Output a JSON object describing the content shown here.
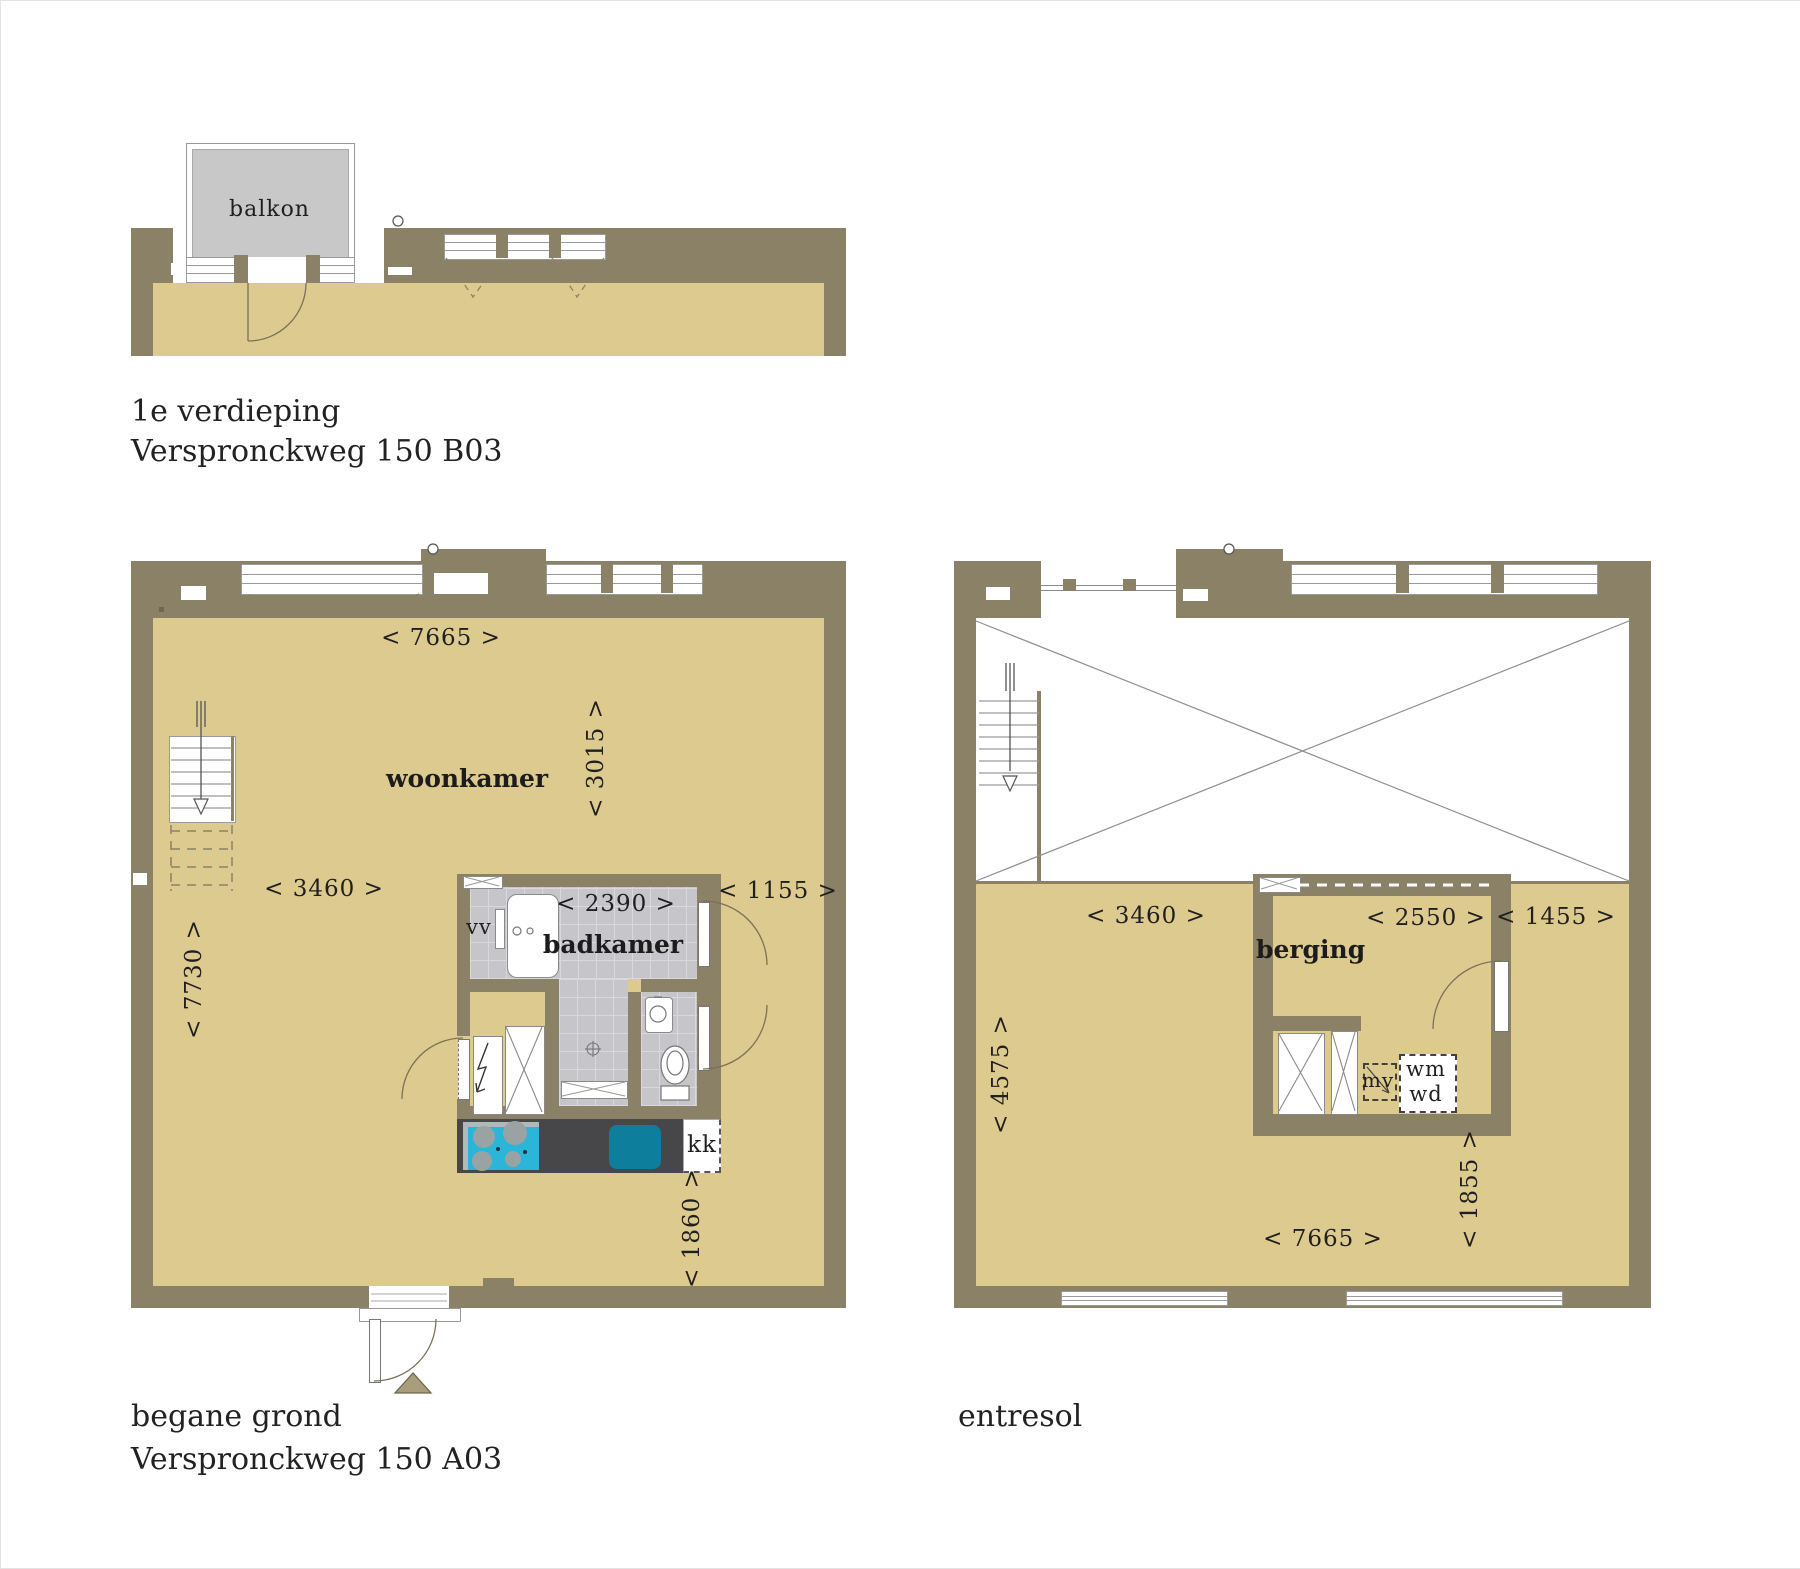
{
  "first_floor": {
    "title": "1e verdieping",
    "address": "Verspronckweg 150 B03",
    "balcony": "balkon"
  },
  "ground_floor": {
    "title": "begane grond",
    "address": "Verspronckweg 150 A03",
    "living_room": "woonkamer",
    "bathroom": "badkamer",
    "vv": "vv",
    "kk": "kk",
    "dim_top_width": "< 7665 >",
    "dim_upper_right": "< 3015 >",
    "dim_mid_width": "< 3460 >",
    "dim_left_height": "< 7730 >",
    "dim_bathroom": "< 2390 >",
    "dim_corridor": "< 1155 >",
    "dim_kitchen": "< 1860 >"
  },
  "entresol": {
    "title": "entresol",
    "storage": "berging",
    "mv": "mv",
    "wm": "wm",
    "wd": "wd",
    "dim_floor_width": "< 3460 >",
    "dim_storage": "< 2550 >",
    "dim_corridor": "< 1455 >",
    "dim_left_height": "< 4575 >",
    "dim_right_lower": "< 1855 >",
    "dim_bottom_width": "< 7665 >"
  },
  "colors": {
    "wall": "#8b8166",
    "floor": "#ddca8e",
    "tile": "#c6c6ca",
    "balcony": "#c8c8c8",
    "counter": "#47474a",
    "hob": "#2ab5d9",
    "sink": "#0d7f9d"
  }
}
